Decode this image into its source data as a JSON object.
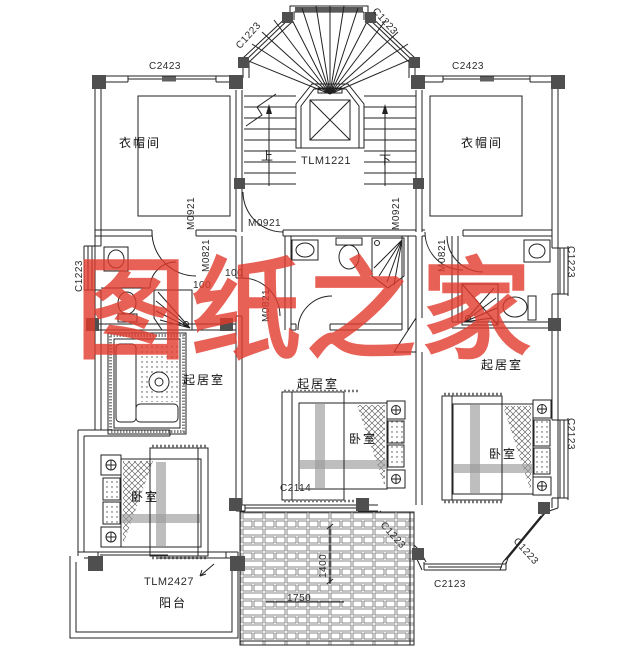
{
  "watermark": {
    "text": "图纸之家",
    "color": "#e23a2c"
  },
  "labels": {
    "c1223_stair_left": "C1223",
    "c1223_stair_right": "C1223",
    "c2423_left": "C2423",
    "c2423_right": "C2423",
    "cloakroom_left": "衣帽间",
    "cloakroom_right": "衣帽间",
    "up": "上",
    "stair_door": "TLM1221",
    "down": "下",
    "m0921_left": "M0921",
    "m0921_center": "M0921",
    "m0921_right": "M0921",
    "m0821_left": "M0821",
    "m0821_center": "M0821",
    "m0821_right": "M0821",
    "c1223_left_wall": "C1223",
    "c1223_right_wall": "C1223",
    "dim_100_a": "100",
    "dim_100_b": "100",
    "living_left": "起居室",
    "living_center": "起居室",
    "living_right": "起居室",
    "bedroom_left": "卧室",
    "bedroom_center": "卧室",
    "bedroom_right": "卧室",
    "c2114": "C2114",
    "c2123_right_wall": "C2123",
    "c1223_bay_upper": "C1223",
    "c1223_bay_lower": "C1223",
    "c2123_bay_bottom": "C2123",
    "balcony_door": "TLM2427",
    "balcony": "阳台",
    "roof_dim_v": "1400",
    "roof_dim_h": "1750"
  }
}
